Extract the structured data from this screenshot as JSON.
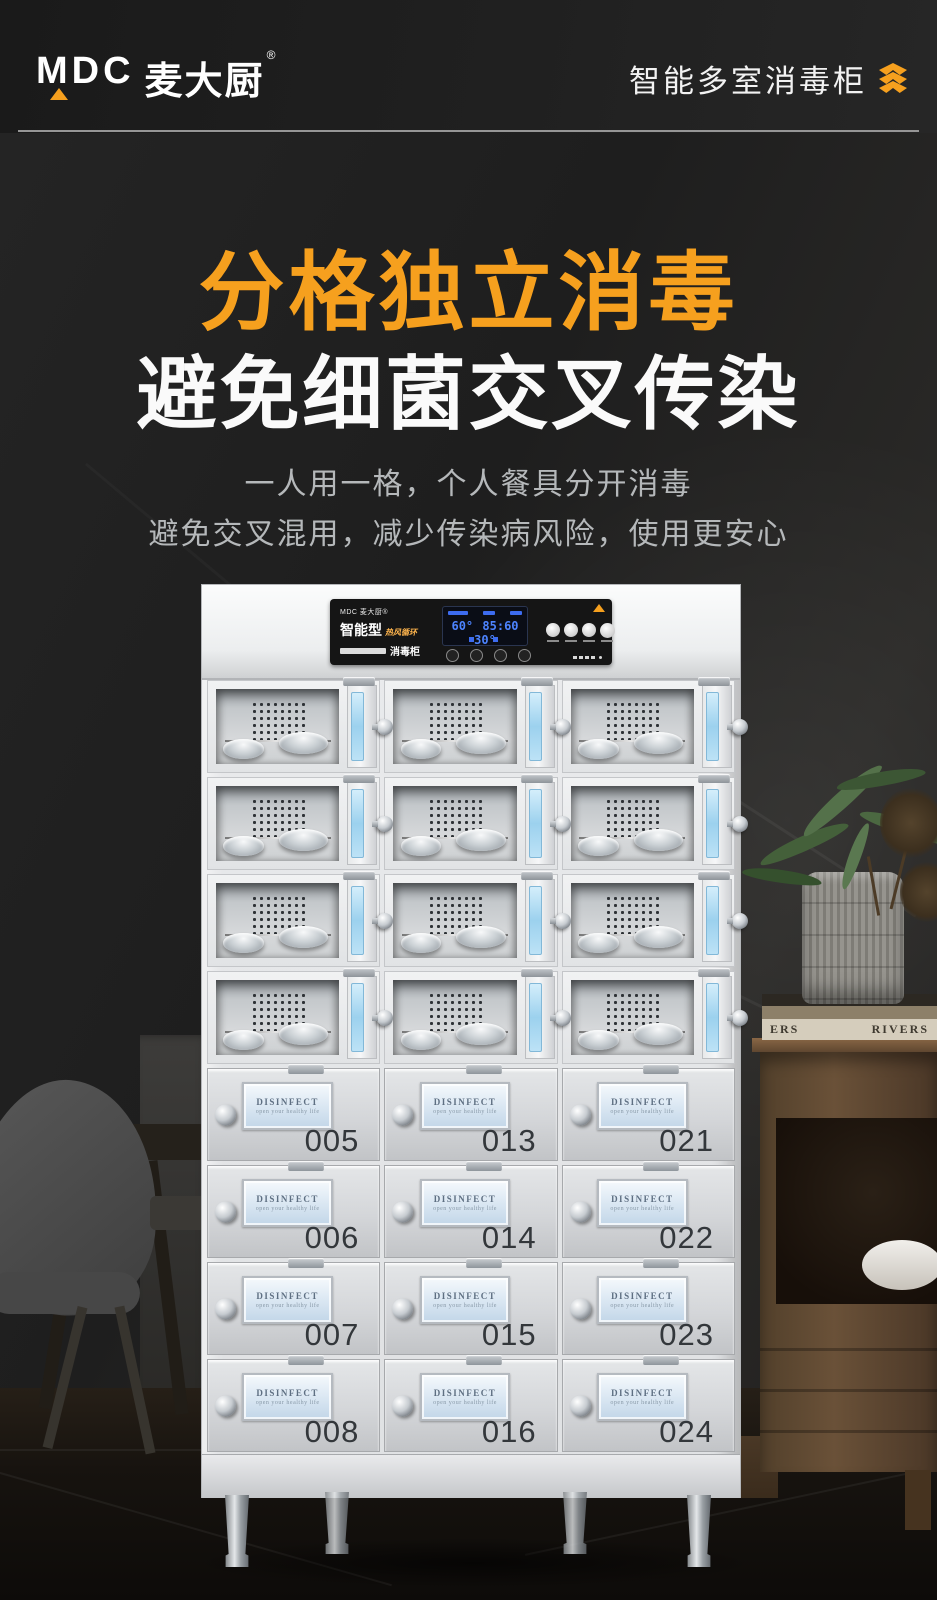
{
  "header": {
    "brand_latin": "MDC",
    "brand_cn": "麦大厨",
    "registered_mark": "®",
    "tagline": "智能多室消毒柜"
  },
  "hero": {
    "title_line1": "分格独立消毒",
    "title_line2": "避免细菌交叉传染",
    "desc_line1": "一人用一格，个人餐具分开消毒",
    "desc_line2": "避免交叉混用，减少传染病风险，使用更安心"
  },
  "control_panel": {
    "brand_small": "MDC 麦大厨®",
    "type_label": "智能型",
    "feature_label": "热风循环",
    "product_label": "消毒柜",
    "lcd": {
      "left_value": "60°",
      "center_value": "85:60",
      "right_value": "30°"
    }
  },
  "drawers": {
    "window_title": "DISINFECT",
    "window_subtitle": "open your healthy life",
    "numbers": [
      "005",
      "013",
      "021",
      "006",
      "014",
      "022",
      "007",
      "015",
      "023",
      "008",
      "016",
      "024"
    ]
  },
  "scene": {
    "book_spine_left": "ERS",
    "book_spine_right": "RIVERS"
  },
  "colors": {
    "accent_orange": "#F6A01E",
    "title_white": "#FAFAFA",
    "desc_gray": "#B5B8BA",
    "lcd_blue": "#4D84FF",
    "door_glass_blue": "#9CD1EE"
  }
}
